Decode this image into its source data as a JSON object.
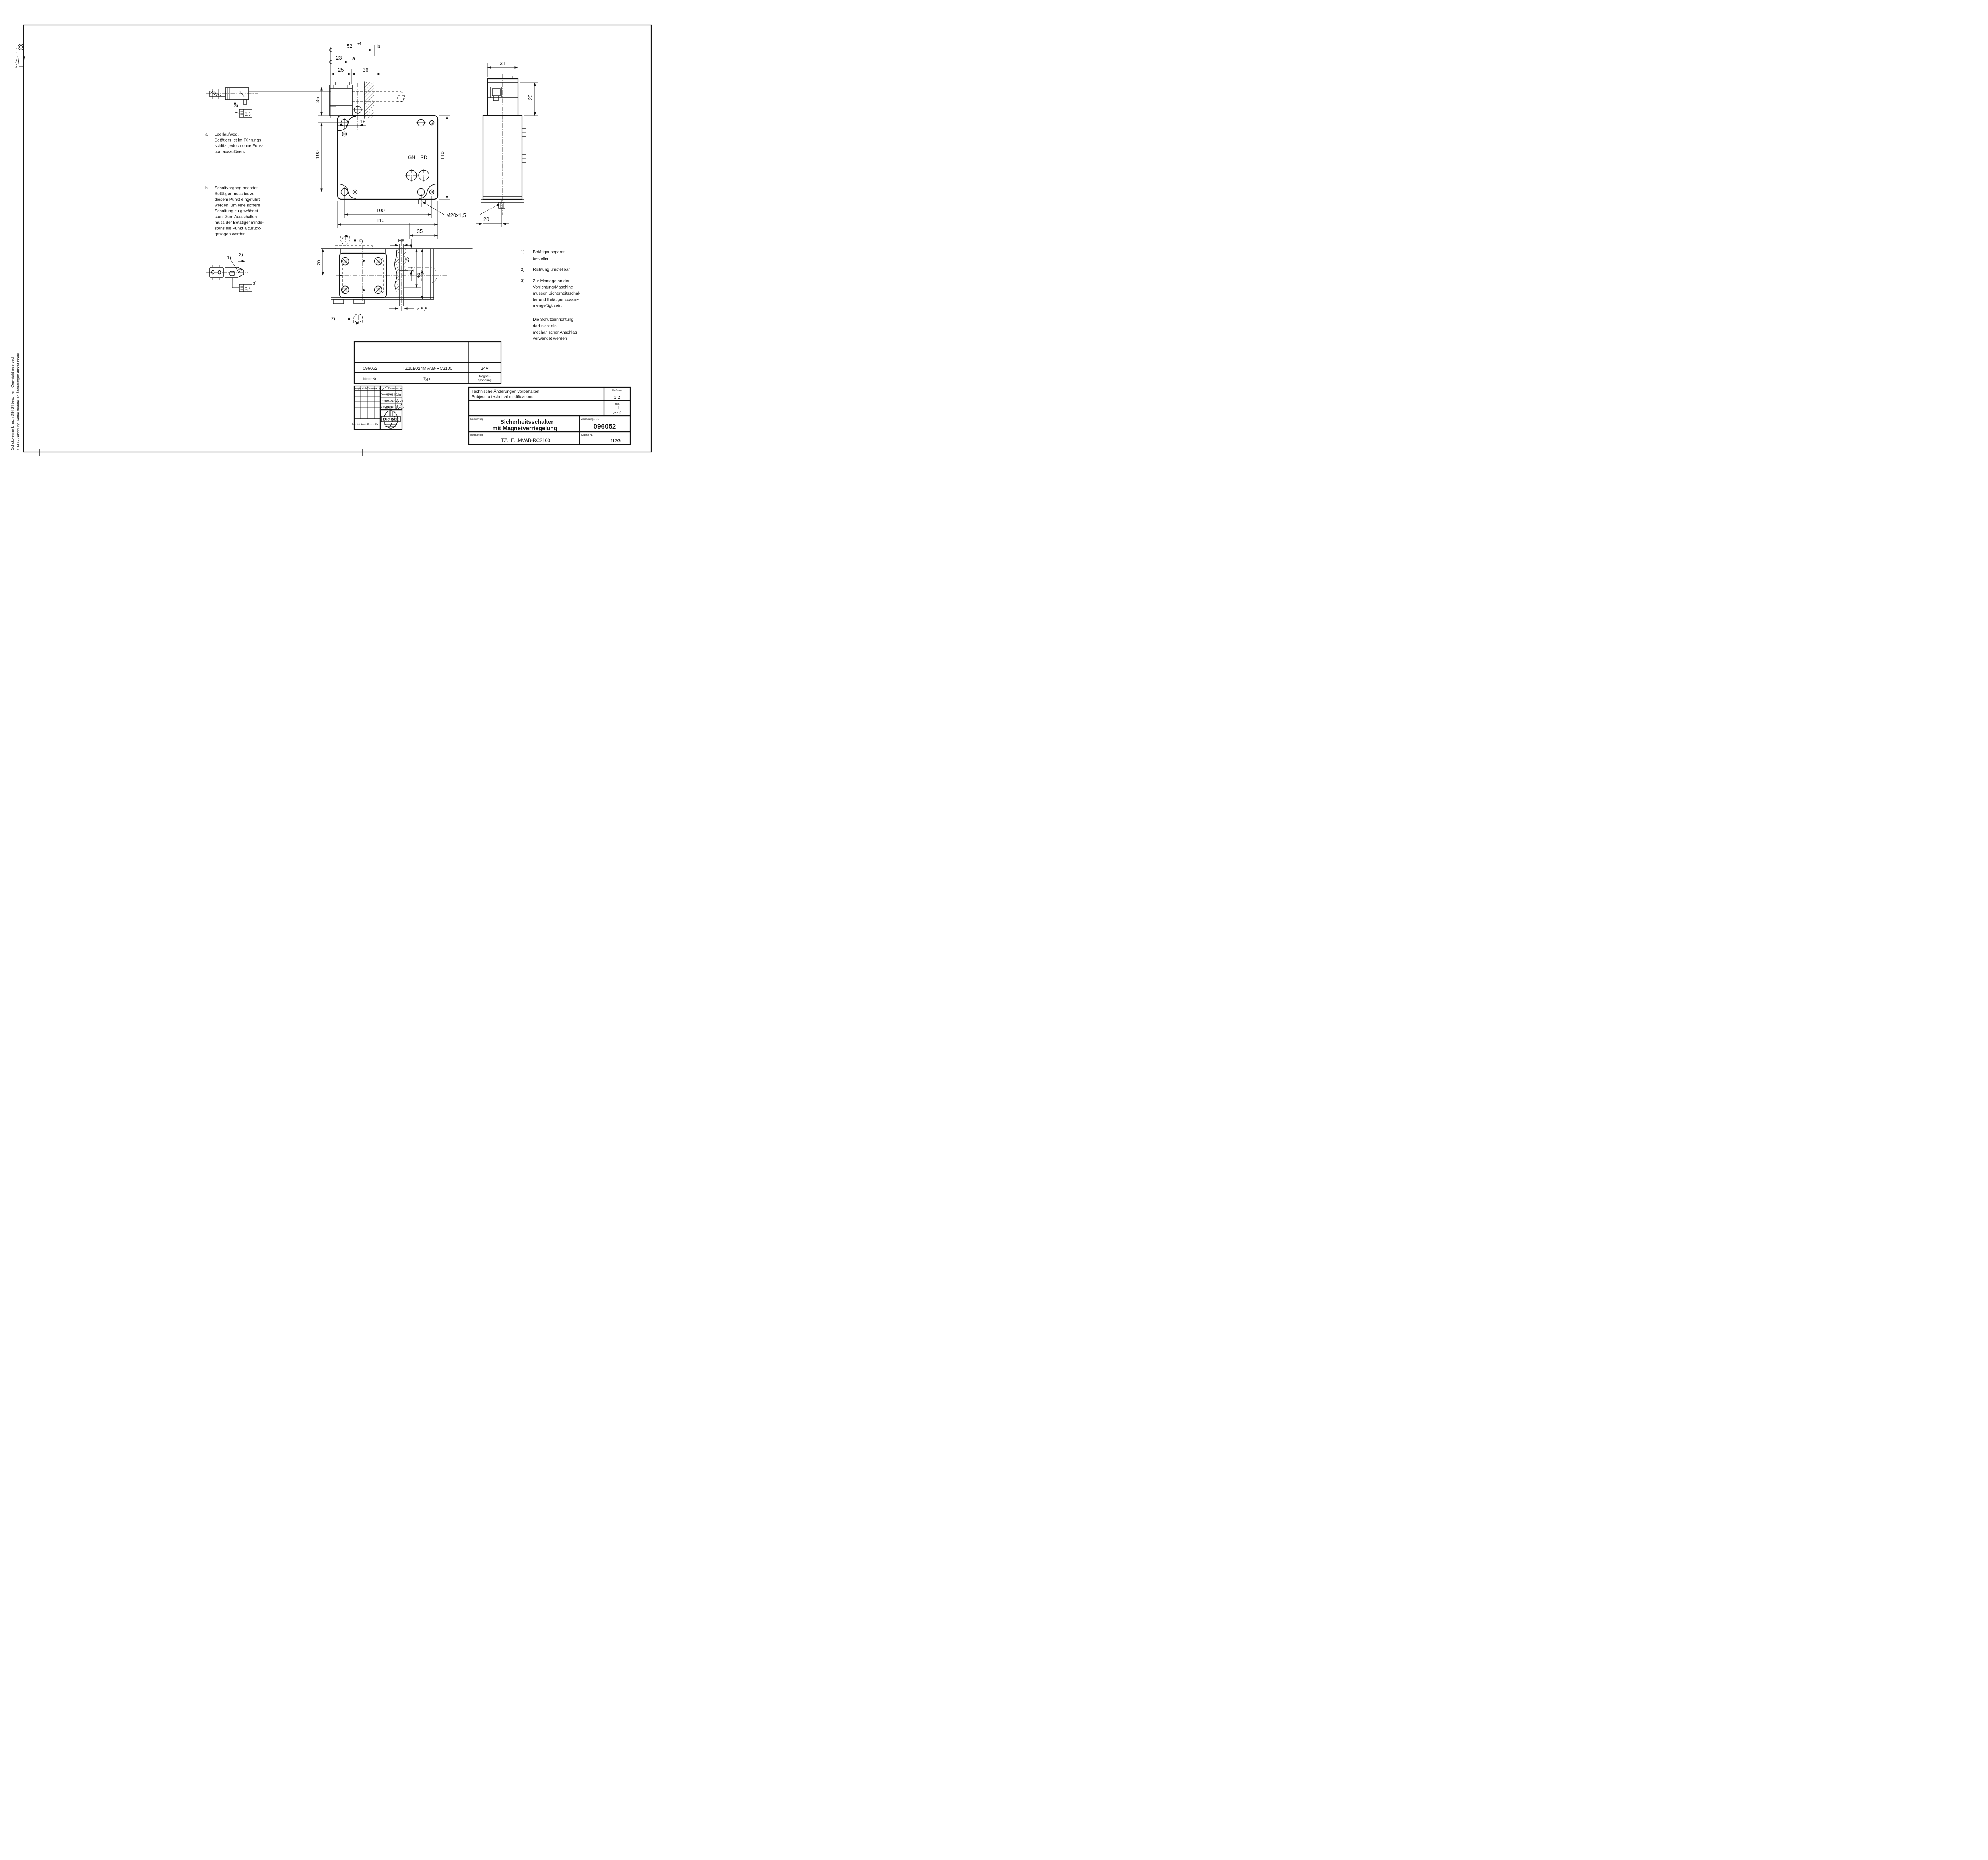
{
  "page": {
    "margin_note_1": "CAD - Zeichnung, keine manuellen Änderungen durchführen!",
    "margin_note_2": "Schutzvermerk nach DIN 34 beachten. Copyright reserved.",
    "units_note": "Maße in mm"
  },
  "notes": {
    "a_label": "a",
    "a_lines": [
      "Leerlaufweg.",
      "Betätiger ist im Führungs-",
      "schlitz, jedoch ohne Funk-",
      "tion auszulösen."
    ],
    "b_label": "b",
    "b_lines": [
      "Schaltvorgang beendet.",
      "Betätiger muss bis zu",
      "diesem Punkt eingeführt",
      "werden, um eine sichere",
      "Schaltung zu gewährlei-",
      "sten. Zum Ausschalten",
      "muss der Betätiger minde-",
      "stens bis Punkt a zurück-",
      "gezogen werden."
    ],
    "n1_label": "1)",
    "n1_lines": [
      "Betätiger separat",
      "bestellen"
    ],
    "n2_label": "2)",
    "n2_lines": [
      "Richtung umstellbar"
    ],
    "n3_label": "3)",
    "n3_lines": [
      "Zur Montage an der",
      "Vorrichtung/Maschine",
      "müssen Sicherheitsschal-",
      "ter und Betätiger zusam-",
      "mengefügt sein."
    ],
    "protection_lines": [
      "Die Schutzeinrichtung",
      "darf nicht als",
      "mechanischer Anschlag",
      "verwendet werden"
    ]
  },
  "dims": {
    "d52": "52",
    "d52_tol": "+4",
    "d23": "23",
    "d25": "25",
    "d36": "36",
    "v36": "36",
    "v100": "100",
    "d18": "18",
    "gn": "GN",
    "rd": "RD",
    "v110": "110",
    "d100": "100",
    "d110": "110",
    "d35": "35",
    "m20": "M20x1,5",
    "d31": "31",
    "v20": "20",
    "d20_side": "20",
    "m8": "M8",
    "d15": "15",
    "d37": "37",
    "d46": "46",
    "d20_bottom": "20",
    "dia55": "ø 5,5"
  },
  "flags": {
    "a": "a",
    "b": "b",
    "r1": "1)",
    "r2": "2)",
    "r2b": "2)",
    "r2c": "2)",
    "r3": "3)",
    "r3b": "3)",
    "tol": "0,3",
    "tol2": "0,3"
  },
  "title_block": {
    "ident_value": "096052",
    "type_value": "TZ1LE024MVAB-RC2100",
    "voltage_value": "24V",
    "ident_label": "Ident-Nr.",
    "type_label": "Type",
    "voltage_label_1": "Magnet-",
    "voltage_label_2": "spannung",
    "rev_headers": [
      "Ausg.",
      "Änd.-Nr.",
      "Datum",
      "Name"
    ],
    "sig_headers": [
      "Datum",
      "Name"
    ],
    "sig_rows": [
      {
        "label": "Bearbeitet",
        "date": "09.01.06",
        "name": "Lin"
      },
      {
        "label": "Geprüft",
        "date": "09.01.05",
        "name": ""
      },
      {
        "label": "Genehmigt",
        "date": "09.01.06",
        "name": ""
      }
    ],
    "ersetzt_durch": "Ersetzt durch",
    "ersatz_fuer": "Ersatz für",
    "tech_note_1": "Technische Änderungen vorbehalten",
    "tech_note_2": "Subject to technical modifications",
    "masstab_label": "Maßstab",
    "masstab_value": "1:2",
    "blatt_label": "Blatt",
    "blatt_value": "1",
    "blatt_von": "von 2",
    "benennung_label": "Benennung",
    "benennung_1": "Sicherheitsschalter",
    "benennung_2": "mit Magnetverriegelung",
    "zeichnung_label": "Zeichnungs-Nr.",
    "zeichnung_value": "096052",
    "bemerkung_label": "Bemerkung",
    "bemerkung_value": "TZ.LE...MVAB-RC2100",
    "klasse_label": "Klasse-Nr.",
    "klasse_value": "112G",
    "logo_text": "EUCHNER"
  }
}
